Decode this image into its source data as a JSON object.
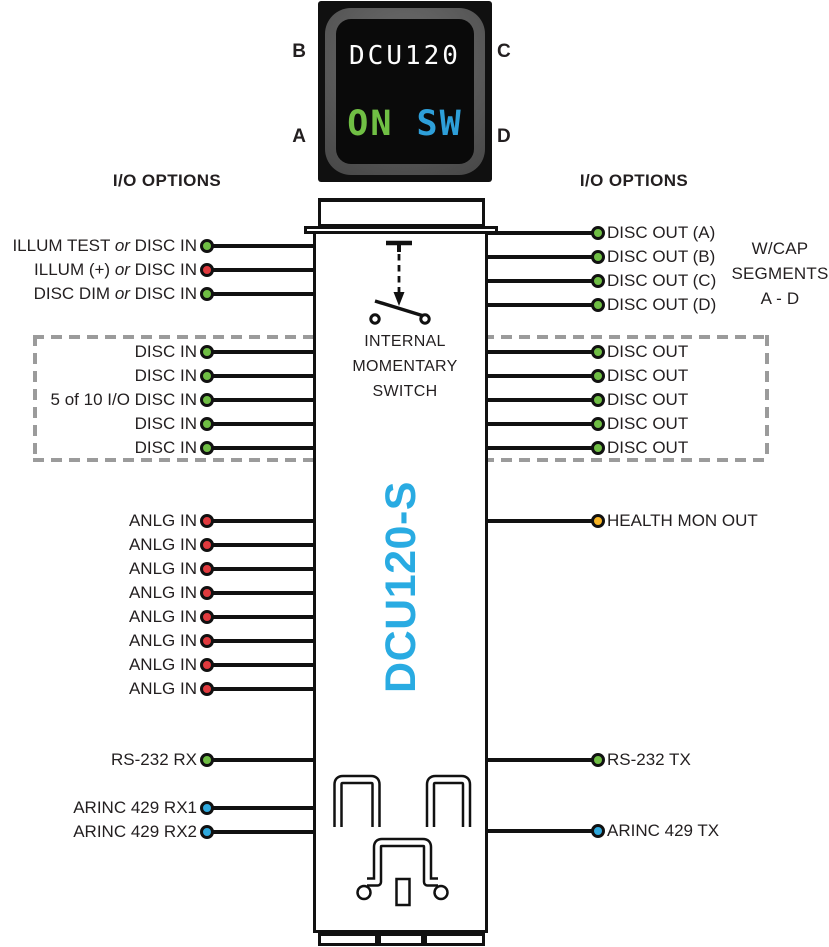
{
  "photo": {
    "display_model": "DCU120",
    "display_on": "ON",
    "display_sw": "SW",
    "corner_labels": {
      "top_left": "B",
      "top_right": "C",
      "bottom_left": "A",
      "bottom_right": "D"
    }
  },
  "headers": {
    "left": "I/O OPTIONS",
    "right": "I/O OPTIONS"
  },
  "annotations": {
    "wcap_lines": [
      "W/CAP",
      "SEGMENTS",
      "A - D"
    ]
  },
  "device": {
    "vertical_label": "DCU120-S",
    "switch_caption_lines": [
      "INTERNAL",
      "MOMENTARY",
      "SWITCH"
    ]
  },
  "colors": {
    "pin_green": "#6FBE44",
    "pin_red": "#E03A3E",
    "pin_blue": "#2FA9DD",
    "pin_yellow": "#F7B424",
    "accent_blue": "#29ABE2",
    "display_on_green": "#70BF44",
    "display_sw_blue": "#2E9FD9"
  },
  "left_pins": {
    "groups": [
      {
        "id": "illum",
        "rows": [
          {
            "label": "ILLUM TEST or DISC IN",
            "color": "green"
          },
          {
            "label": "ILLUM (+) or DISC IN",
            "color": "red"
          },
          {
            "label": "DISC DIM or DISC IN",
            "color": "green"
          }
        ]
      },
      {
        "id": "disc-in",
        "rows": [
          {
            "label": "DISC IN",
            "color": "green"
          },
          {
            "label": "DISC IN",
            "color": "green"
          },
          {
            "label": "5 of 10 I/O DISC IN",
            "color": "green"
          },
          {
            "label": "DISC IN",
            "color": "green"
          },
          {
            "label": "DISC IN",
            "color": "green"
          }
        ]
      },
      {
        "id": "anlg",
        "rows": [
          {
            "label": "ANLG IN",
            "color": "red"
          },
          {
            "label": "ANLG IN",
            "color": "red"
          },
          {
            "label": "ANLG IN",
            "color": "red"
          },
          {
            "label": "ANLG IN",
            "color": "red"
          },
          {
            "label": "ANLG IN",
            "color": "red"
          },
          {
            "label": "ANLG IN",
            "color": "red"
          },
          {
            "label": "ANLG IN",
            "color": "red"
          },
          {
            "label": "ANLG IN",
            "color": "red"
          }
        ]
      },
      {
        "id": "serial",
        "rows": [
          {
            "label": "RS-232 RX",
            "color": "green"
          }
        ]
      },
      {
        "id": "arinc",
        "rows": [
          {
            "label": "ARINC 429 RX1",
            "color": "blue"
          },
          {
            "label": "ARINC 429 RX2",
            "color": "blue"
          }
        ]
      }
    ]
  },
  "right_pins": {
    "groups": [
      {
        "id": "cap",
        "rows": [
          {
            "label": "DISC OUT (A)",
            "color": "green"
          },
          {
            "label": "DISC OUT (B)",
            "color": "green"
          },
          {
            "label": "DISC OUT (C)",
            "color": "green"
          },
          {
            "label": "DISC OUT (D)",
            "color": "green"
          }
        ]
      },
      {
        "id": "disc-out",
        "rows": [
          {
            "label": "DISC OUT",
            "color": "green"
          },
          {
            "label": "DISC OUT",
            "color": "green"
          },
          {
            "label": "DISC OUT",
            "color": "green"
          },
          {
            "label": "DISC OUT",
            "color": "green"
          },
          {
            "label": "DISC OUT",
            "color": "green"
          }
        ]
      },
      {
        "id": "health",
        "rows": [
          {
            "label": "HEALTH MON OUT",
            "color": "yellow"
          }
        ]
      },
      {
        "id": "serial",
        "rows": [
          {
            "label": "RS-232 TX",
            "color": "green"
          }
        ]
      },
      {
        "id": "arinc",
        "rows": [
          {
            "label": "ARINC 429 TX",
            "color": "blue"
          }
        ]
      }
    ]
  }
}
